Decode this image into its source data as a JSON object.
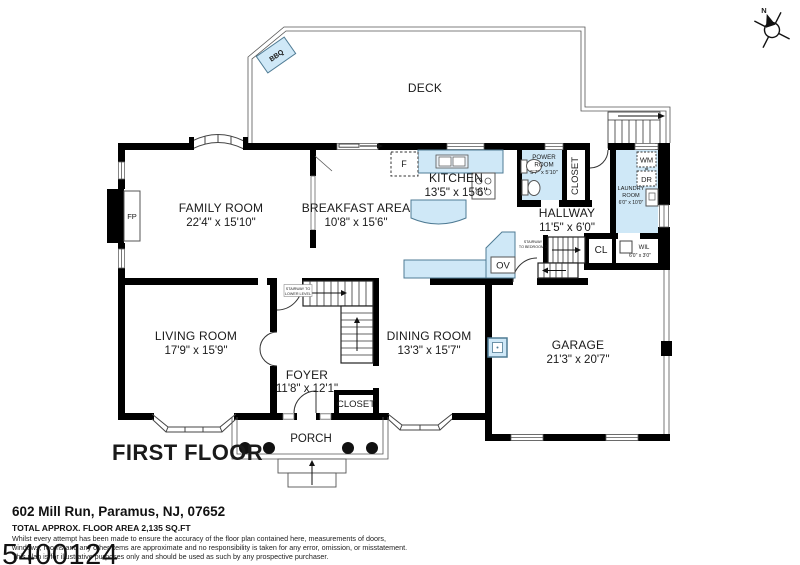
{
  "colors": {
    "fixture_fill": "#cfe8f7",
    "fixture_stroke": "#4f7b94",
    "wall": "#000000"
  },
  "compass": {
    "north_label": "N"
  },
  "deck": {
    "label": "DECK",
    "bbq_label": "BBQ"
  },
  "rooms": {
    "family": {
      "name": "FAMILY ROOM",
      "dims": "22'4\" x 15'10\""
    },
    "breakfast": {
      "name": "BREAKFAST AREA",
      "dims": "10'8\" x 15'6\""
    },
    "kitchen": {
      "name": "KITCHEN",
      "dims": "13'5\" x 15'6\""
    },
    "power": {
      "line1": "POWER",
      "line2": "ROOM",
      "dims": "5'7\" x 5'10\""
    },
    "hallway": {
      "name": "HALLWAY",
      "dims": "11'5\" x 6'0\""
    },
    "laundry": {
      "line1": "LAUNDRY",
      "line2": "ROOM",
      "dims": "6'0\" x 10'0\""
    },
    "living": {
      "name": "LIVING ROOM",
      "dims": "17'9\" x 15'9\""
    },
    "foyer": {
      "name": "FOYER",
      "dims": "11'8\" x 12'1\""
    },
    "dining": {
      "name": "DINING ROOM",
      "dims": "13'3\" x 15'7\""
    },
    "garage": {
      "name": "GARAGE",
      "dims": "21'3\" x 20'7\""
    },
    "porch": {
      "name": "PORCH"
    }
  },
  "fixtures": {
    "fireplace": "FP",
    "fridge": "F",
    "oven": "OV",
    "washer": "WM",
    "dryer": "DR",
    "hookup": "="
  },
  "closets": {
    "pantry": "CLOSET",
    "foyer_closet": "CLOSET",
    "cl": "CL",
    "wil": "WIL",
    "wil_dims": "6'0\" x 3'0\""
  },
  "stairs": {
    "lower_line1": "STAIRWAY TO",
    "lower_line2": "LOWER LEVEL",
    "bedroom_line1": "STAIRWAY",
    "bedroom_line2": "TO BEDROOM 2"
  },
  "plan_title": "FIRST FLOOR",
  "footer": {
    "address": "602 Mill Run, Paramus, NJ, 07652",
    "area": "TOTAL APPROX. FLOOR AREA 2,135 SQ.FT",
    "disclaimer1": "Whilst every attempt has been made to ensure the accuracy of the floor plan contained here, measurements of doors,",
    "disclaimer2": "windows, rooms and any other items are approximate and no responsibility is taken for any error, omission, or misstatement.",
    "disclaimer3": "This plan is for illustrative purposes only and should be used as such by any prospective purchaser.",
    "watermark": "5400124"
  }
}
